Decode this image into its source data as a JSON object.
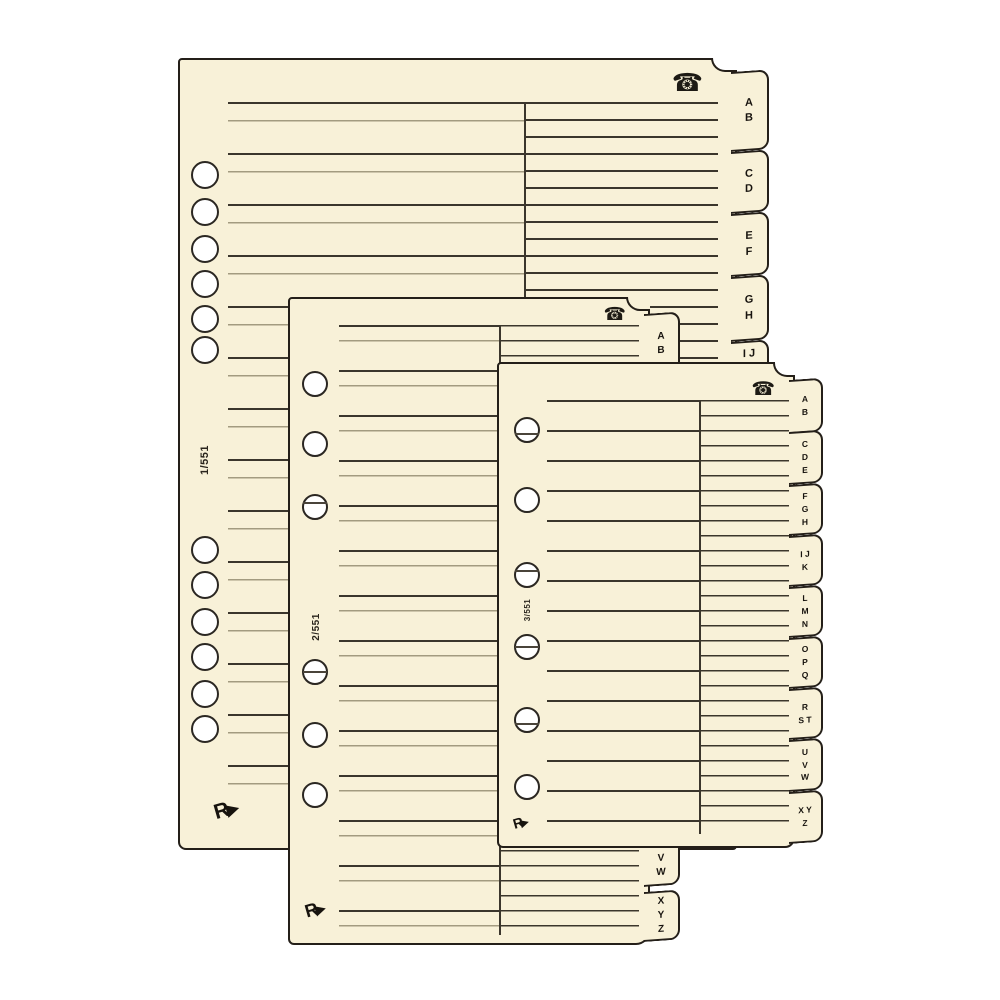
{
  "image": {
    "type": "product-photo",
    "subject": "telephone-address-index-refill-sheets",
    "background_color": "#ffffff"
  },
  "colors": {
    "paper": "#f8f1d8",
    "outline": "#241f19",
    "rule_dark": "#3b362c",
    "rule_light": "#a39b80"
  },
  "sheets": [
    {
      "name": "large telephone index sheet",
      "page_marker": "1/551",
      "phone_icon": "☎",
      "brand_logo": "R",
      "brand_arrow": "▶",
      "hole_count": 12,
      "tabs": [
        {
          "label": "A B"
        },
        {
          "label": "C D"
        },
        {
          "label": "E F"
        },
        {
          "label": "G H"
        },
        {
          "label": "I J"
        }
      ]
    },
    {
      "name": "medium telephone index sheet",
      "page_marker": "2/551",
      "phone_icon": "☎",
      "brand_logo": "R",
      "brand_arrow": "▶",
      "hole_count": 6,
      "tabs": [
        {
          "label": "A B"
        },
        {
          "label": "U V W"
        },
        {
          "label": "X Y Z"
        }
      ]
    },
    {
      "name": "small telephone index sheet",
      "page_marker": "3/551",
      "phone_icon": "☎",
      "brand_logo": "R",
      "brand_arrow": "▶",
      "hole_count": 6,
      "tabs": [
        {
          "label": "A B"
        },
        {
          "label": "C D E"
        },
        {
          "label": "F G H"
        },
        {
          "label": "I J K"
        },
        {
          "label": "L M N"
        },
        {
          "label": "O P Q"
        },
        {
          "label": "R S T"
        },
        {
          "label": "U V W"
        },
        {
          "label": "X Y Z"
        }
      ]
    }
  ]
}
